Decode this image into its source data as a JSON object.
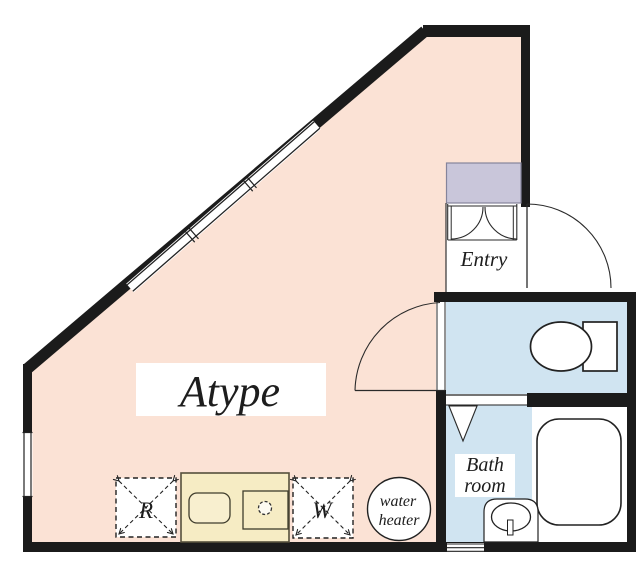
{
  "plan": {
    "labels": {
      "unit": "Atype",
      "entry": "Entry",
      "bath_line1": "Bath",
      "bath_line2": "room",
      "water_heater_line1": "water",
      "water_heater_line2": "heater",
      "refrigerator": "R",
      "washing_machine": "W"
    },
    "colors": {
      "background": "#ffffff",
      "main_room_fill": "#fbe2d5",
      "wet_area_fill": "#d0e4f1",
      "closet_fill": "#c9c6da",
      "kitchen_fill": "#f6ecc4",
      "kitchen_inner_fill": "#f8efcf",
      "wall": "#1b1b1b",
      "line": "#2a2a2a",
      "fixture_fill": "#ffffff"
    }
  }
}
